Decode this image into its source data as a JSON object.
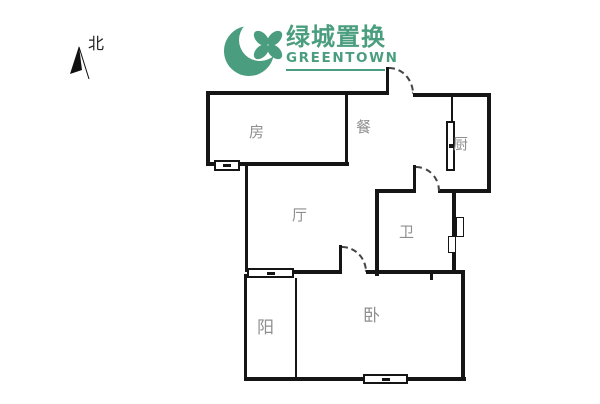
{
  "brand": {
    "name_cn": "绿城置换",
    "name_en": "GREENTOWN",
    "brand_color": "#4a9e7f"
  },
  "compass": {
    "label": "北"
  },
  "rooms": {
    "fang": {
      "label": "房"
    },
    "dining": {
      "label": "餐"
    },
    "kitchen": {
      "label": "厨"
    },
    "living": {
      "label": "厅"
    },
    "bathroom": {
      "label": "卫"
    },
    "balcony": {
      "label": "阳"
    },
    "bedroom": {
      "label": "卧"
    }
  },
  "palette": {
    "wall_color": "#151515",
    "label_color": "#8f8f8f",
    "background": "#ffffff"
  }
}
